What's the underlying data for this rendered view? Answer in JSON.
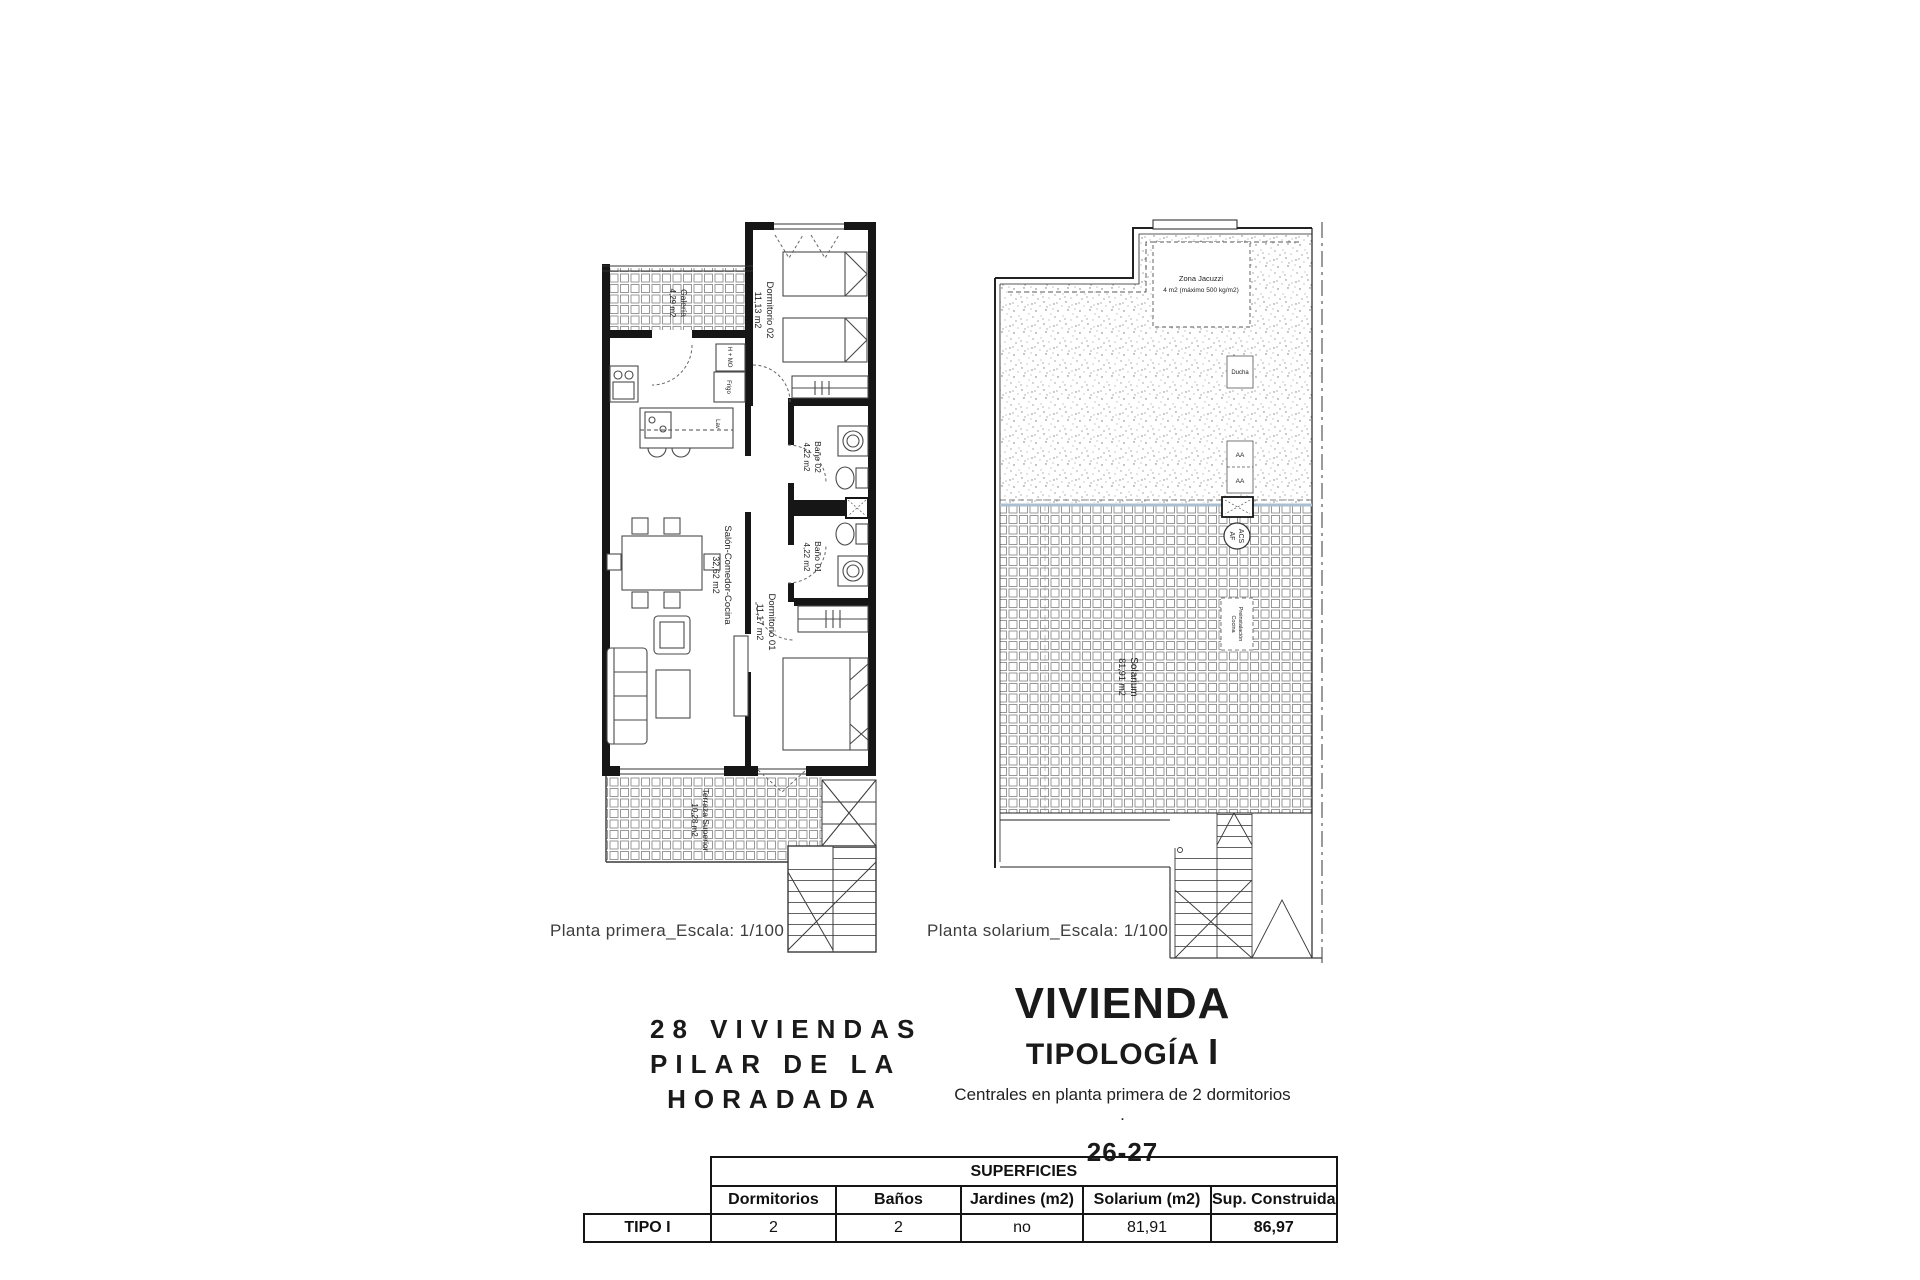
{
  "plans": {
    "primera": {
      "caption": "Planta primera_Escala: 1/100",
      "rooms": {
        "galeria": {
          "name": "Galería",
          "area": "4,29 m2"
        },
        "dormitorio02": {
          "name": "Dormitorio 02",
          "area": "11,13 m2"
        },
        "salon": {
          "name": "Salón-Comedor-Cocina",
          "area": "32,62 m2"
        },
        "bano02": {
          "name": "Baño 02",
          "area": "4,22 m2"
        },
        "bano01": {
          "name": "Baño 01",
          "area": "4,22 m2"
        },
        "dormitorio01": {
          "name": "Dormitorio 01",
          "area": "11,17 m2"
        },
        "terraza": {
          "name": "Terraza Superior",
          "area": "10,28 m2"
        }
      },
      "annotations": {
        "h_mo": "H + MO",
        "frigo": "Frigo",
        "lav": "Lav"
      }
    },
    "solarium": {
      "caption": "Planta solarium_Escala: 1/100",
      "rooms": {
        "solarium": {
          "name": "Solarium",
          "area": "81,91 m2"
        },
        "jacuzzi": {
          "name": "Zona Jacuzzi",
          "note": "4 m2 (máximo 500 kg/m2)"
        }
      },
      "annotations": {
        "ducha": "Ducha",
        "aa_top": "AA",
        "aa_bottom": "AA",
        "acs": "ACS",
        "af": "AF",
        "preinstalacion_line1": "Preinstalación",
        "preinstalacion_line2": "Cocina"
      }
    }
  },
  "title_block": {
    "project_line1": "28 VIVIENDAS",
    "project_line2": "PILAR DE LA",
    "project_line3": "HORADADA",
    "heading": "VIVIENDA",
    "subheading": "TIPOLOGÍA",
    "type_letter": "I",
    "description": "Centrales en planta primera de 2 dormitorios .",
    "units": "26-27"
  },
  "table": {
    "title": "SUPERFICIES",
    "columns": [
      "Dormitorios",
      "Baños",
      "Jardines (m2)",
      "Solarium (m2)",
      "Sup. Construida"
    ],
    "row_label": "TIPO I",
    "values": [
      "2",
      "2",
      "no",
      "81,91",
      "86,97"
    ]
  },
  "colors": {
    "line": "#161616",
    "tile_line": "#8a8a8a",
    "pool_line": "#aabfd2"
  }
}
